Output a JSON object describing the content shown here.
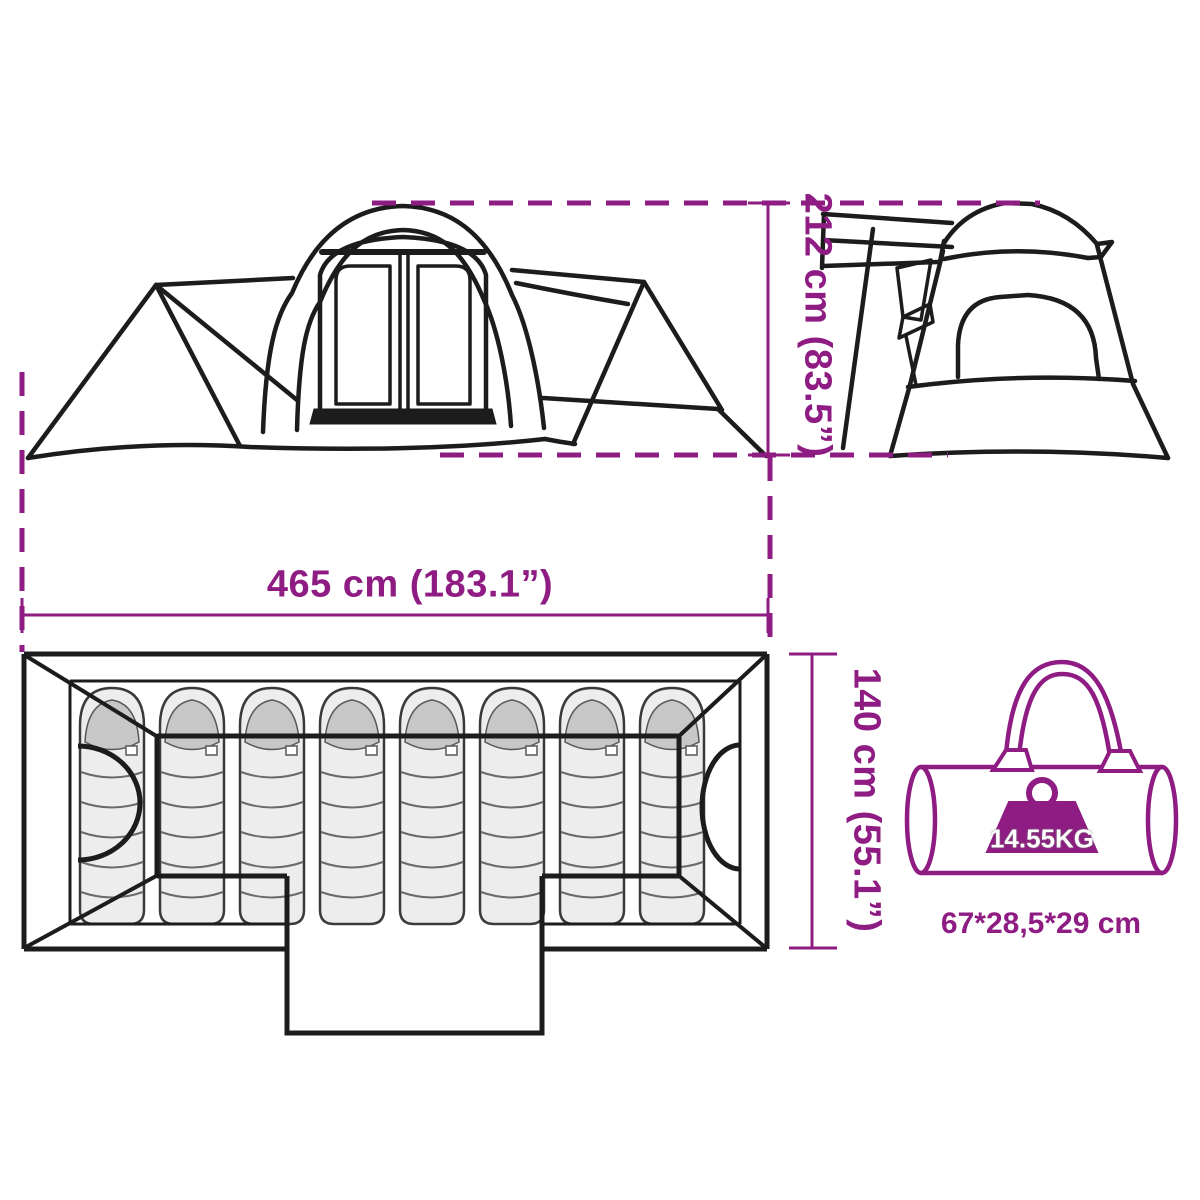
{
  "meta": {
    "type": "product-dimension-diagram",
    "subject": "family camping tent with 8 sleeping places and carry bag"
  },
  "colors": {
    "accent": "#8E1C82",
    "line": "#1c1c1c",
    "sleeping_bag_fill": "#ededed",
    "hood_fill": "#c7c7c7"
  },
  "dimensions": {
    "height_label": "212 cm (83.5”)",
    "width_label": "465 cm (183.1”)",
    "depth_label": "140 cm (55.1”)"
  },
  "carry_bag": {
    "weight_label": "14.55KG",
    "size_label": "67*28,5*29 cm"
  },
  "floor_plan": {
    "sleeping_bag_count": 8
  },
  "icons": {
    "weight": "weight-icon",
    "carry_bag": "carry-bag",
    "door": "door-arc"
  }
}
